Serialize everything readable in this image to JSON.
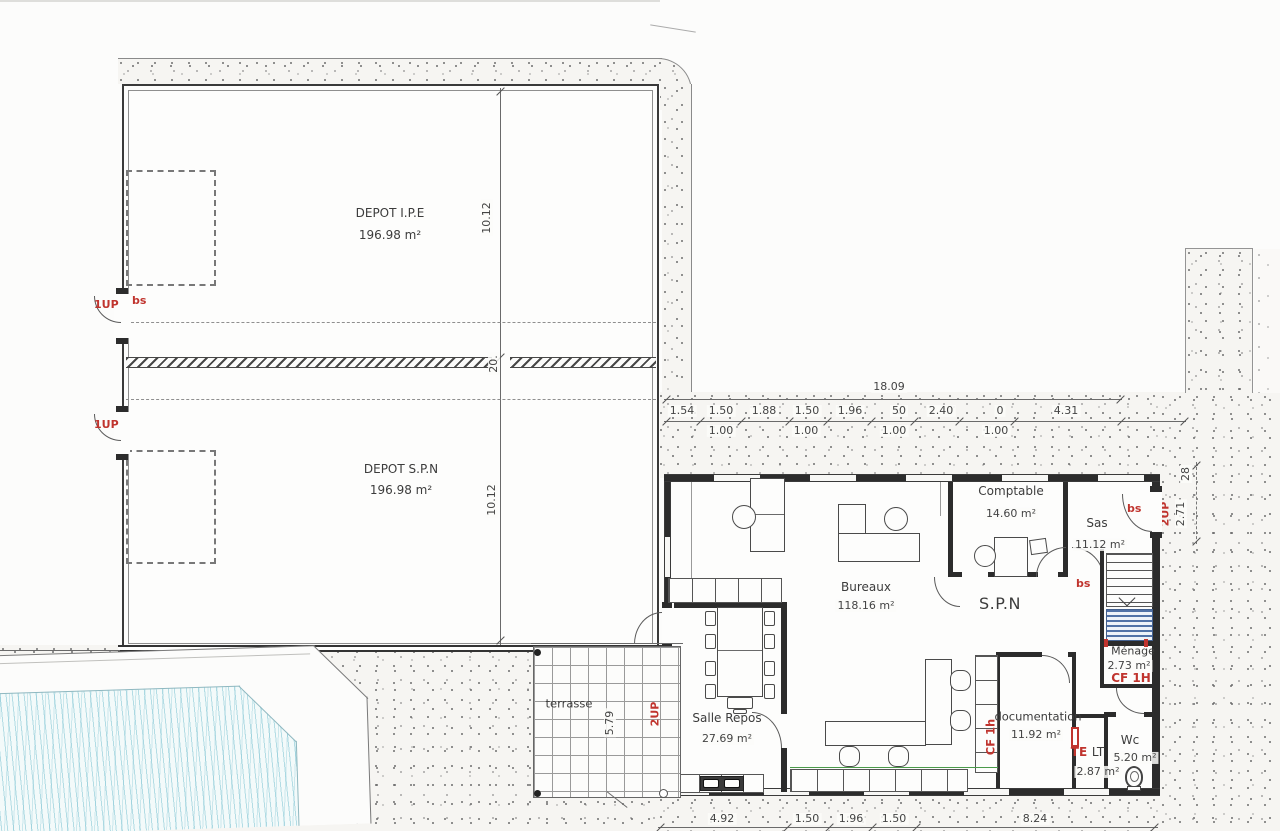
{
  "rooms": {
    "depot_ipe": {
      "name": "DEPOT I.P.E",
      "area": "196.98 m²"
    },
    "depot_spn": {
      "name": "DEPOT S.P.N",
      "area": "196.98 m²"
    },
    "bureaux": {
      "name": "Bureaux",
      "area": "118.16 m²"
    },
    "spn": {
      "name": "S.P.N"
    },
    "comptable": {
      "name": "Comptable",
      "area": "14.60 m²"
    },
    "sas": {
      "name": "Sas",
      "area": "11.12 m²"
    },
    "menage": {
      "name": "Ménage",
      "area": "2.73 m²"
    },
    "documentation": {
      "name": "documentation",
      "area": "11.92 m²"
    },
    "lt": {
      "name": "LT",
      "area": "2.87 m²"
    },
    "wc": {
      "name": "Wc",
      "area": "5.20 m²"
    },
    "salle_repos": {
      "name": "Salle Repos",
      "area": "27.69 m²"
    },
    "terrasse": {
      "name": "terrasse"
    }
  },
  "dims": {
    "overall": "18.09",
    "chain": [
      "1.54",
      "1.50",
      "1.88",
      "1.50",
      "1.96",
      "50",
      "2.40",
      "0",
      "4.31"
    ],
    "sub": [
      "1.00",
      "1.00",
      "1.00",
      "1.00"
    ],
    "depot_upper": "10.12",
    "depot_lower": "10.12",
    "wall": "20.",
    "right_offset": "28",
    "right_height": "2.71",
    "terrasse_depth": "5.79",
    "bottom": [
      "4.92",
      "1.50",
      "1.96",
      "1.50",
      "8.24"
    ]
  },
  "ann": {
    "up1": "1UP",
    "bs": "bs",
    "up2": "2UP",
    "cf_big": "CF 1H",
    "cf_small": "CF 1h",
    "te": "TE"
  }
}
